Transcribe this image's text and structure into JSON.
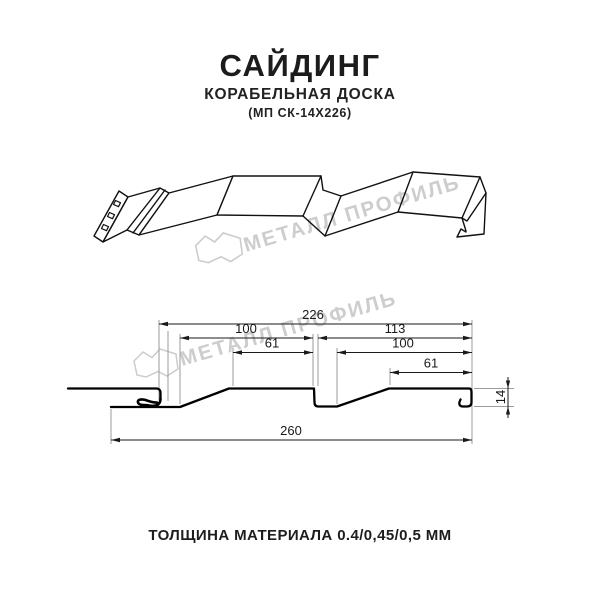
{
  "title": {
    "main": "САЙДИНГ",
    "subtitle": "КОРАБЕЛЬНАЯ ДОСКА",
    "model": "(МП СК-14Х226)"
  },
  "caption": "ТОЛЩИНА МАТЕРИАЛА 0.4/0,45/0,5 ММ",
  "watermark": {
    "text": "МЕТАЛЛ ПРОФИЛЬ",
    "color": "#cdcdcd"
  },
  "drawing": {
    "line_color": "#111111",
    "dim_color": "#1a1a1a",
    "ext_color": "#9b9b9b",
    "dimensions": {
      "total_width": "260",
      "profile_width": "226",
      "panel1_width": "100",
      "panel2_width": "113",
      "panel1_flat": "61",
      "panel2_inner": "100",
      "panel2_flat": "61",
      "height": "14"
    }
  }
}
